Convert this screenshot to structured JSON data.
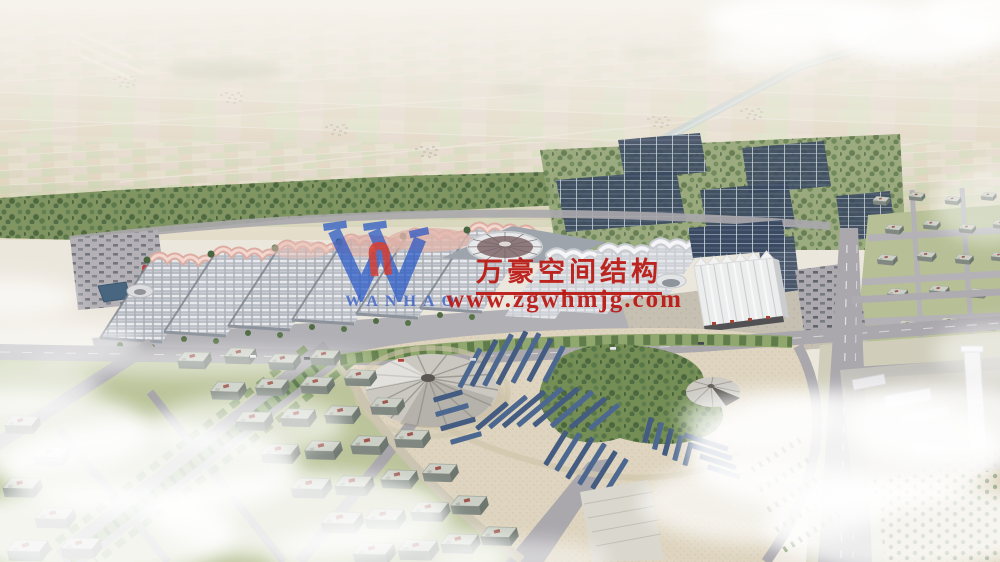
{
  "watermark": {
    "company_name": "万豪空间结构",
    "website": "www.zgwhmjg.com",
    "logo_text": "WANHAO",
    "logo_letter": "W",
    "brand_red": "#bb1712",
    "brand_blue": "#2b57c9"
  }
}
